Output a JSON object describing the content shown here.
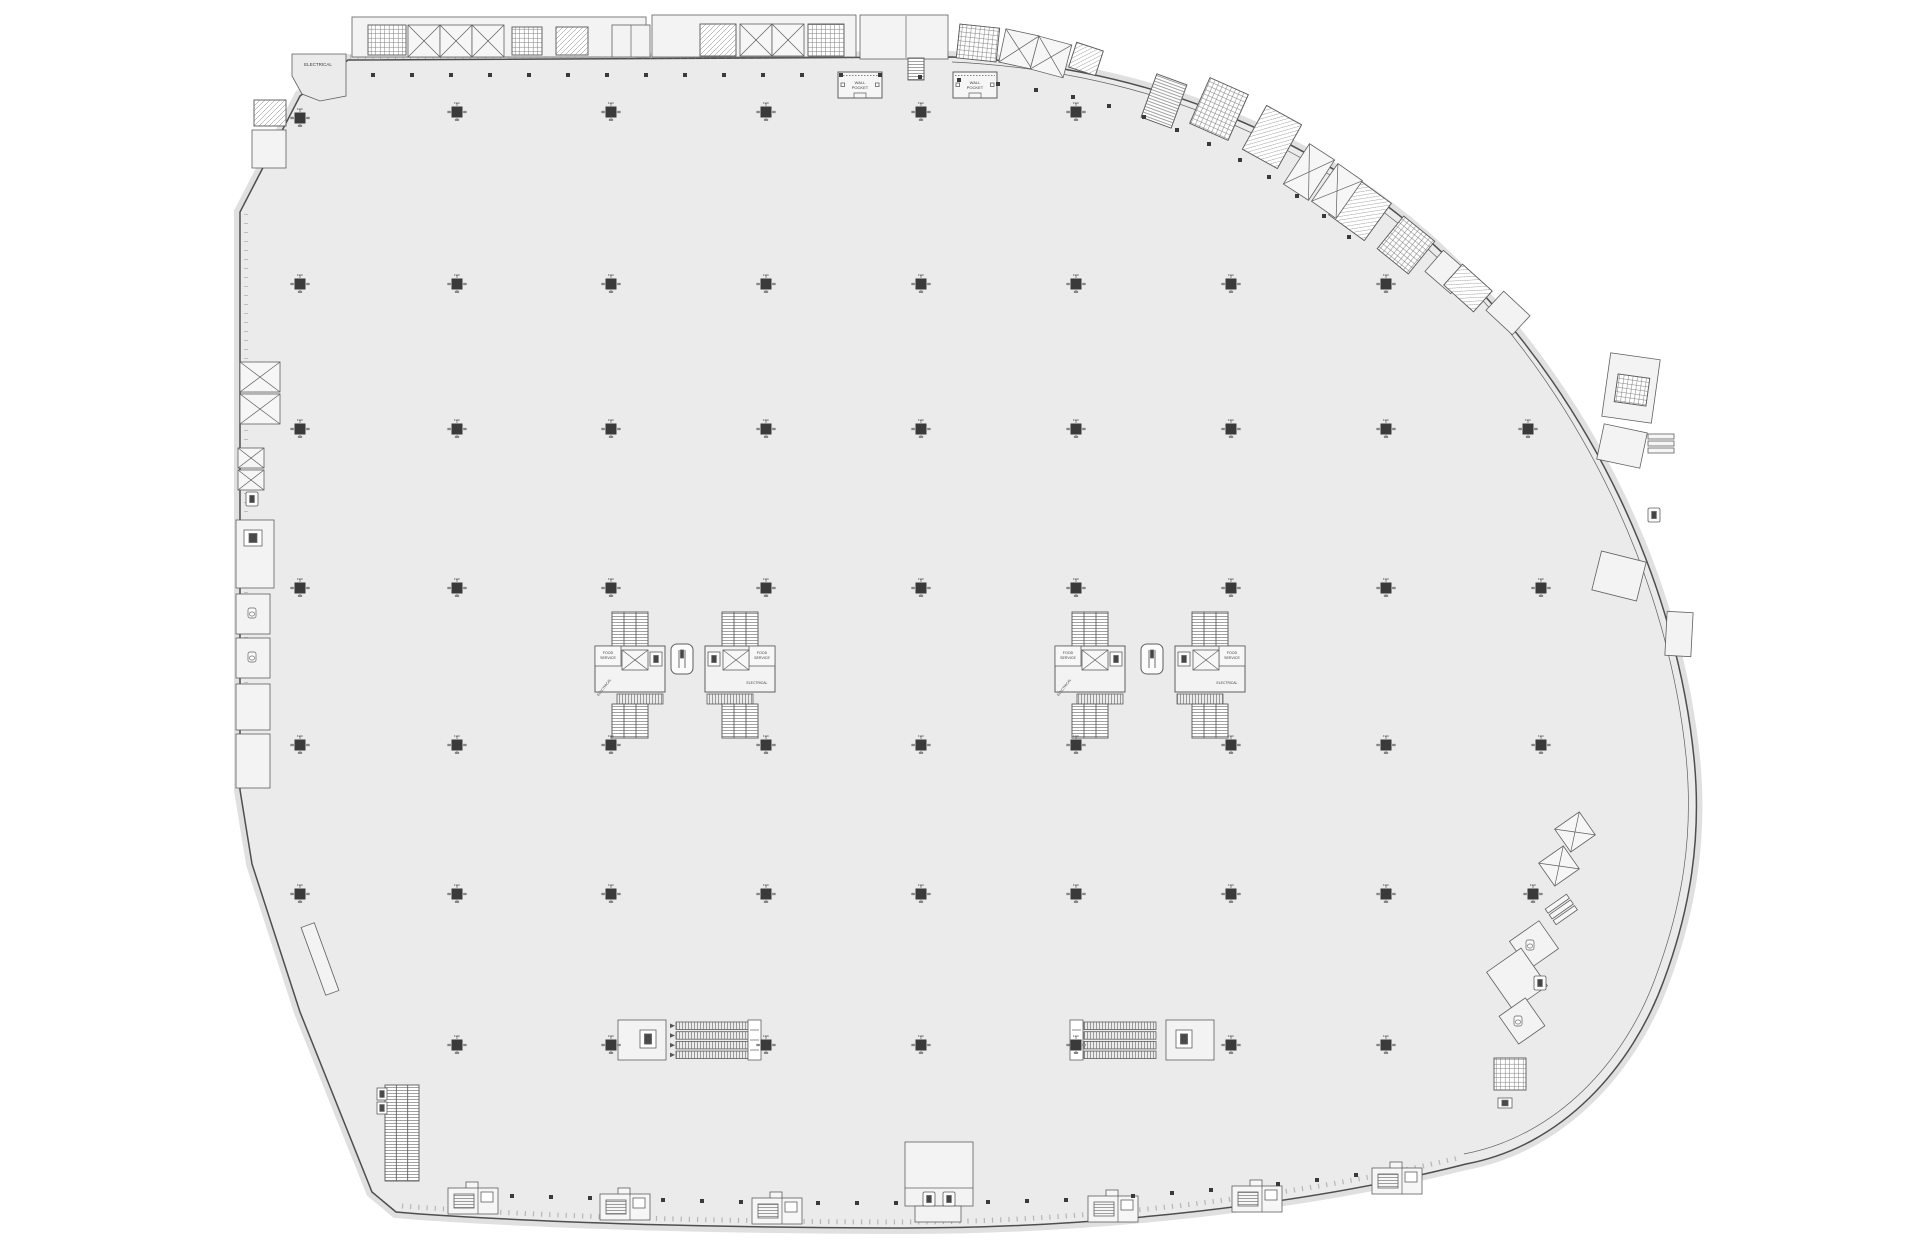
{
  "plan": {
    "colors": {
      "page_background": "#ffffff",
      "floor_fill": "#ebebeb",
      "outline": "#4e4e4e",
      "thin_line": "#5f5f5f",
      "hatch_line": "#787878",
      "column_fill": "#3a3a3a",
      "perimeter_band": "#e0e0e0",
      "room_fill": "#f3f3f3",
      "text": "#3c3c3c"
    },
    "column_note": "FHC",
    "wall_pocket_label_lines": [
      "WALL",
      "POCKET"
    ],
    "core_labels": {
      "food_lines": [
        "FOOD",
        "SERVICE"
      ],
      "electrical": "ELECTRICAL"
    },
    "labels": [
      [
        "ELECTRICAL",
        318,
        66,
        0,
        4.5
      ],
      [
        "ELECTRICAL",
        259,
        556,
        -90,
        4.5
      ],
      [
        "ELECTRICAL",
        641,
        1042,
        -90,
        4
      ],
      [
        "ELECTRICAL",
        1189,
        1042,
        -90,
        4
      ]
    ],
    "columns": [
      [
        300,
        118
      ],
      [
        457,
        112
      ],
      [
        611,
        112
      ],
      [
        766,
        112
      ],
      [
        921,
        112
      ],
      [
        1076,
        112
      ],
      [
        300,
        284
      ],
      [
        457,
        284
      ],
      [
        611,
        284
      ],
      [
        766,
        284
      ],
      [
        921,
        284
      ],
      [
        1076,
        284
      ],
      [
        1231,
        284
      ],
      [
        1386,
        284
      ],
      [
        300,
        429
      ],
      [
        457,
        429
      ],
      [
        611,
        429
      ],
      [
        766,
        429
      ],
      [
        921,
        429
      ],
      [
        1076,
        429
      ],
      [
        1231,
        429
      ],
      [
        1386,
        429
      ],
      [
        1528,
        429
      ],
      [
        300,
        588
      ],
      [
        457,
        588
      ],
      [
        611,
        588
      ],
      [
        766,
        588
      ],
      [
        921,
        588
      ],
      [
        1076,
        588
      ],
      [
        1231,
        588
      ],
      [
        1386,
        588
      ],
      [
        1541,
        588
      ],
      [
        300,
        745
      ],
      [
        457,
        745
      ],
      [
        611,
        745
      ],
      [
        766,
        745
      ],
      [
        921,
        745
      ],
      [
        1076,
        745
      ],
      [
        1231,
        745
      ],
      [
        1386,
        745
      ],
      [
        1541,
        745
      ],
      [
        300,
        894
      ],
      [
        457,
        894
      ],
      [
        611,
        894
      ],
      [
        766,
        894
      ],
      [
        921,
        894
      ],
      [
        1076,
        894
      ],
      [
        1231,
        894
      ],
      [
        1386,
        894
      ],
      [
        1533,
        894
      ],
      [
        457,
        1045
      ],
      [
        611,
        1045
      ],
      [
        766,
        1045
      ],
      [
        921,
        1045
      ],
      [
        1076,
        1045
      ],
      [
        1231,
        1045
      ],
      [
        1386,
        1045
      ]
    ],
    "dots": [
      [
        373,
        75
      ],
      [
        412,
        75
      ],
      [
        451,
        75
      ],
      [
        490,
        75
      ],
      [
        529,
        75
      ],
      [
        568,
        75
      ],
      [
        607,
        75
      ],
      [
        646,
        75
      ],
      [
        685,
        75
      ],
      [
        724,
        75
      ],
      [
        763,
        75
      ],
      [
        802,
        75
      ],
      [
        841,
        75
      ],
      [
        880,
        75
      ],
      [
        920,
        77
      ],
      [
        959,
        80
      ],
      [
        998,
        84
      ],
      [
        1036,
        90
      ],
      [
        1073,
        97
      ],
      [
        1109,
        106
      ],
      [
        1144,
        117
      ],
      [
        1177,
        130
      ],
      [
        1209,
        144
      ],
      [
        1240,
        160
      ],
      [
        1269,
        177
      ],
      [
        1297,
        196
      ],
      [
        1324,
        216
      ],
      [
        1349,
        237
      ],
      [
        512,
        1196
      ],
      [
        551,
        1197
      ],
      [
        590,
        1198
      ],
      [
        663,
        1200
      ],
      [
        702,
        1201
      ],
      [
        741,
        1202
      ],
      [
        818,
        1203
      ],
      [
        857,
        1203
      ],
      [
        896,
        1203
      ],
      [
        988,
        1202
      ],
      [
        1027,
        1201
      ],
      [
        1066,
        1200
      ],
      [
        1133,
        1196
      ],
      [
        1172,
        1193
      ],
      [
        1211,
        1190
      ],
      [
        1278,
        1184
      ],
      [
        1317,
        1180
      ],
      [
        1356,
        1175
      ]
    ],
    "rooms": [
      [
        352,
        17,
        294,
        40,
        0
      ],
      [
        652,
        15,
        204,
        42,
        0
      ],
      [
        860,
        15,
        88,
        44,
        0
      ],
      [
        612,
        25,
        38,
        32,
        0
      ],
      [
        1430,
        258,
        34,
        28,
        41
      ],
      [
        1490,
        300,
        36,
        26,
        43
      ],
      [
        252,
        130,
        34,
        38,
        0
      ],
      [
        236,
        520,
        38,
        68,
        0
      ],
      [
        236,
        594,
        34,
        40,
        0
      ],
      [
        236,
        638,
        34,
        40,
        0
      ],
      [
        236,
        684,
        34,
        46,
        0
      ],
      [
        236,
        734,
        34,
        54,
        0
      ],
      [
        284,
        952,
        72,
        14,
        70
      ],
      [
        618,
        1020,
        48,
        40,
        0
      ],
      [
        1166,
        1020,
        48,
        40,
        0
      ],
      [
        905,
        1142,
        68,
        64,
        0
      ],
      [
        915,
        1206,
        46,
        16,
        0
      ],
      [
        1606,
        356,
        50,
        64,
        8
      ],
      [
        1600,
        428,
        44,
        36,
        12
      ],
      [
        1596,
        556,
        46,
        40,
        14
      ],
      [
        1666,
        612,
        26,
        44,
        3
      ],
      [
        1516,
        928,
        36,
        34,
        -35
      ],
      [
        1496,
        956,
        42,
        46,
        -35
      ],
      [
        1506,
        1004,
        32,
        34,
        -35
      ]
    ],
    "hatches": [
      [
        368,
        25,
        38,
        30,
        "grid",
        0
      ],
      [
        512,
        27,
        30,
        28,
        "grid",
        0
      ],
      [
        556,
        27,
        32,
        28,
        "diag",
        0
      ],
      [
        700,
        24,
        36,
        32,
        "diag",
        0
      ],
      [
        808,
        24,
        36,
        32,
        "grid",
        0
      ],
      [
        958,
        26,
        40,
        34,
        "grid",
        6
      ],
      [
        1072,
        46,
        28,
        26,
        "diag",
        18
      ],
      [
        1148,
        78,
        32,
        46,
        "vtread",
        20
      ],
      [
        1198,
        84,
        42,
        50,
        "grid",
        24
      ],
      [
        1252,
        112,
        40,
        50,
        "diag",
        29
      ],
      [
        1338,
        186,
        44,
        46,
        "diag",
        36
      ],
      [
        1386,
        224,
        40,
        42,
        "grid",
        39
      ],
      [
        1448,
        274,
        40,
        28,
        "diag",
        42
      ],
      [
        254,
        100,
        32,
        26,
        "diag",
        0
      ],
      [
        908,
        58,
        16,
        22,
        "vtread",
        0
      ],
      [
        1616,
        376,
        32,
        28,
        "grid",
        8
      ],
      [
        1494,
        1058,
        32,
        32,
        "grid",
        0
      ]
    ],
    "xboxes": [
      [
        408,
        25,
        32,
        32,
        0
      ],
      [
        440,
        25,
        32,
        32,
        0
      ],
      [
        472,
        25,
        32,
        32,
        0
      ],
      [
        740,
        24,
        32,
        32,
        0
      ],
      [
        772,
        24,
        32,
        32,
        0
      ],
      [
        1002,
        32,
        34,
        34,
        12
      ],
      [
        1034,
        40,
        34,
        34,
        15
      ],
      [
        1294,
        148,
        30,
        48,
        33
      ],
      [
        1322,
        168,
        30,
        46,
        35
      ],
      [
        240,
        362,
        40,
        30,
        0
      ],
      [
        240,
        394,
        40,
        30,
        0
      ],
      [
        238,
        448,
        26,
        20,
        0
      ],
      [
        238,
        470,
        26,
        20,
        0
      ],
      [
        1560,
        818,
        30,
        28,
        -35
      ],
      [
        1544,
        852,
        30,
        28,
        -35
      ]
    ],
    "lines": [
      [
        631,
        25,
        631,
        57
      ],
      [
        906,
        16,
        906,
        58
      ],
      [
        905,
        1188,
        973,
        1188
      ]
    ],
    "cores": [
      [
        595,
        612,
        0
      ],
      [
        705,
        612,
        1
      ],
      [
        1055,
        612,
        0
      ],
      [
        1175,
        612,
        1
      ]
    ],
    "esc_v": [
      [
        385,
        1085,
        34,
        96
      ]
    ],
    "esc4": [
      [
        676,
        1022,
        72,
        36
      ],
      [
        1084,
        1022,
        72,
        36
      ]
    ],
    "strips": [
      [
        748,
        1020,
        13,
        40
      ],
      [
        1070,
        1020,
        13,
        40
      ]
    ],
    "elev_big": [
      [
        671,
        644
      ],
      [
        1141,
        644
      ]
    ],
    "elevs": [
      [
        246,
        492
      ],
      [
        923,
        1192
      ],
      [
        943,
        1192
      ],
      [
        1648,
        508
      ],
      [
        1534,
        976
      ]
    ],
    "equips": [
      [
        244,
        530,
        18,
        16
      ],
      [
        377,
        1088,
        10,
        12
      ],
      [
        377,
        1102,
        10,
        12
      ],
      [
        640,
        1030,
        16,
        18
      ],
      [
        1176,
        1030,
        16,
        18
      ],
      [
        1498,
        1098,
        14,
        10
      ]
    ],
    "wcs": [
      [
        248,
        608
      ],
      [
        248,
        652
      ],
      [
        1526,
        940
      ],
      [
        1514,
        1016
      ]
    ],
    "slats": [
      [
        1648,
        434,
        0
      ],
      [
        1548,
        900,
        -35
      ]
    ],
    "vests": [
      [
        448,
        1188
      ],
      [
        600,
        1194
      ],
      [
        752,
        1198
      ],
      [
        1088,
        1196
      ],
      [
        1232,
        1186
      ],
      [
        1372,
        1168
      ]
    ],
    "wall_pockets": [
      [
        838,
        72
      ],
      [
        953,
        72
      ]
    ]
  }
}
